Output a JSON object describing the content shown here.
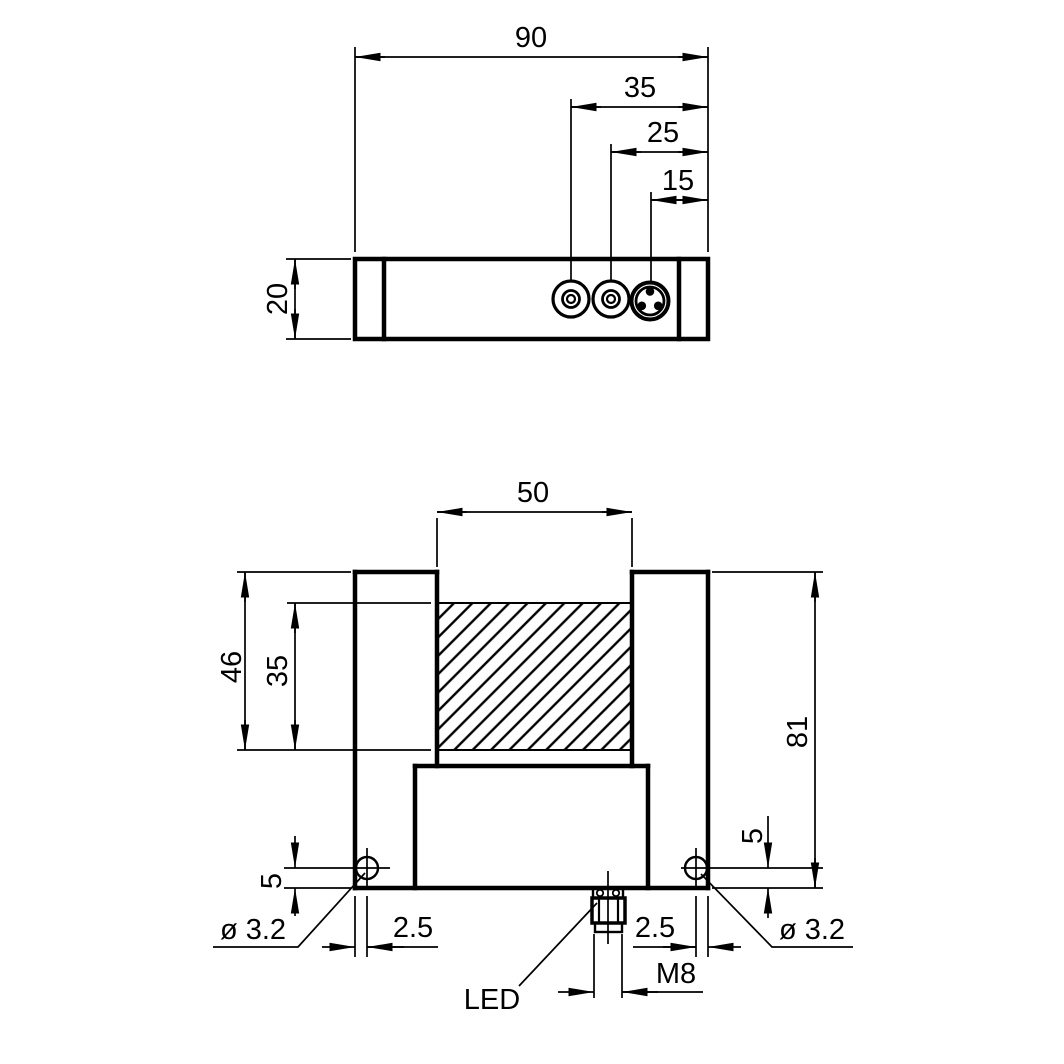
{
  "colors": {
    "line": "#000000",
    "background": "#ffffff"
  },
  "top_view": {
    "dims": {
      "overall_width": "90",
      "knob1_from_right": "35",
      "knob2_from_right": "25",
      "connector_from_right": "15",
      "thickness": "20"
    }
  },
  "front_view": {
    "dims": {
      "slot_width": "50",
      "slot_depth": "46",
      "window_height": "35",
      "overall_height": "81",
      "hole_offset_left": "5",
      "hole_offset_right": "5",
      "hole_inset_left": "2.5",
      "hole_inset_right": "2.5",
      "hole_diameter_left": "ø 3.2",
      "hole_diameter_right": "ø 3.2",
      "connector_thread": "M8",
      "led_label": "LED"
    }
  }
}
